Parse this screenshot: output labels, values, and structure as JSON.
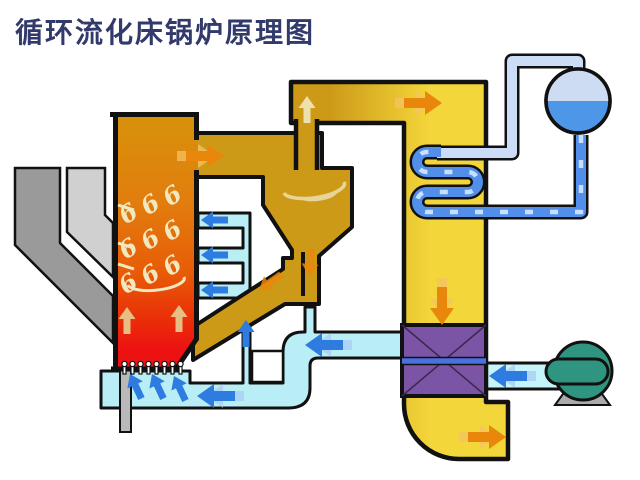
{
  "title": {
    "text": "循环流化床锅炉原理图"
  },
  "swirl": {
    "glyph": "6"
  },
  "colors": {
    "title": "#323A6B",
    "outline": "#111111",
    "air": "#B9EEF6",
    "air_light": "#C6F4FB",
    "cyclone": "#CD9A18",
    "pass_yellow": "#F3D63A",
    "furnace_stops": [
      "#D6930B",
      "#E27D0E",
      "#E85C07",
      "#EA2E08",
      "#ED1212"
    ],
    "pass_stops": [
      "#CD9A18",
      "#F3D63A"
    ],
    "purple": "#7C54A6",
    "strip_blue": "#4A71E0",
    "teal": "#2F9480",
    "drum_steam": "#CDDCF2",
    "drum_water": "#4E97E8",
    "pipe_steam": "#CBDDF6",
    "pipe_blue": "#528FEA",
    "pipe_dash": "#C9E0FC",
    "chute_dark": "#9A9A9A",
    "chute_light": "#D0D0D0",
    "drain": "#B9B9B9",
    "stand": "#ABABAB",
    "nozzle": "#FFFFFF",
    "arrow_orange": "#E8870B",
    "arrow_orange_light": "#F5C263",
    "arrow_blue": "#2E7CE0",
    "arrow_blue_light": "#A6C9F4",
    "arrow_tan": "#E7CD92",
    "swirl_pale": "#F2E8BE",
    "swirl_pale2": "#E6D49A",
    "gap_white": "#FFFFFF"
  }
}
